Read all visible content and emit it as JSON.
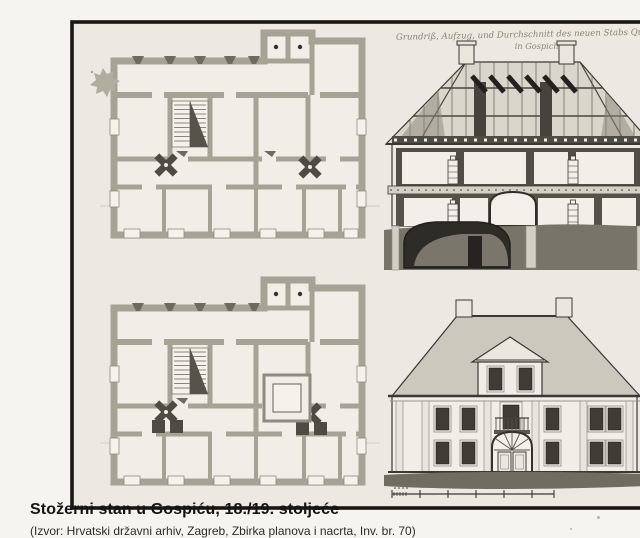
{
  "figure": {
    "handwritten_title": {
      "line1": "Grundriß, Aufzug, und Durchschnitt des neuen Stabs Quartier",
      "line2": "in Gospich."
    }
  },
  "caption": {
    "title": "Stožerni stan u Gospiću, 18./19. stoljeće",
    "source": "(Izvor: Hrvatski državni arhiv, Zagreb, Zbirka planova i nacrta, Inv. br. 70)"
  },
  "colors": {
    "page-bg": "#f5f4f0",
    "paper": "#ebe9e1",
    "frame": "#191712",
    "ink": "#3a3833",
    "wall": "#a6a295",
    "room": "#f0eee6",
    "dark": "#4e4b43",
    "roof-wash": "#cbc8be",
    "ground-wash": "#747167",
    "caption-ink": "#141414",
    "handwriting": "#8a8574"
  }
}
